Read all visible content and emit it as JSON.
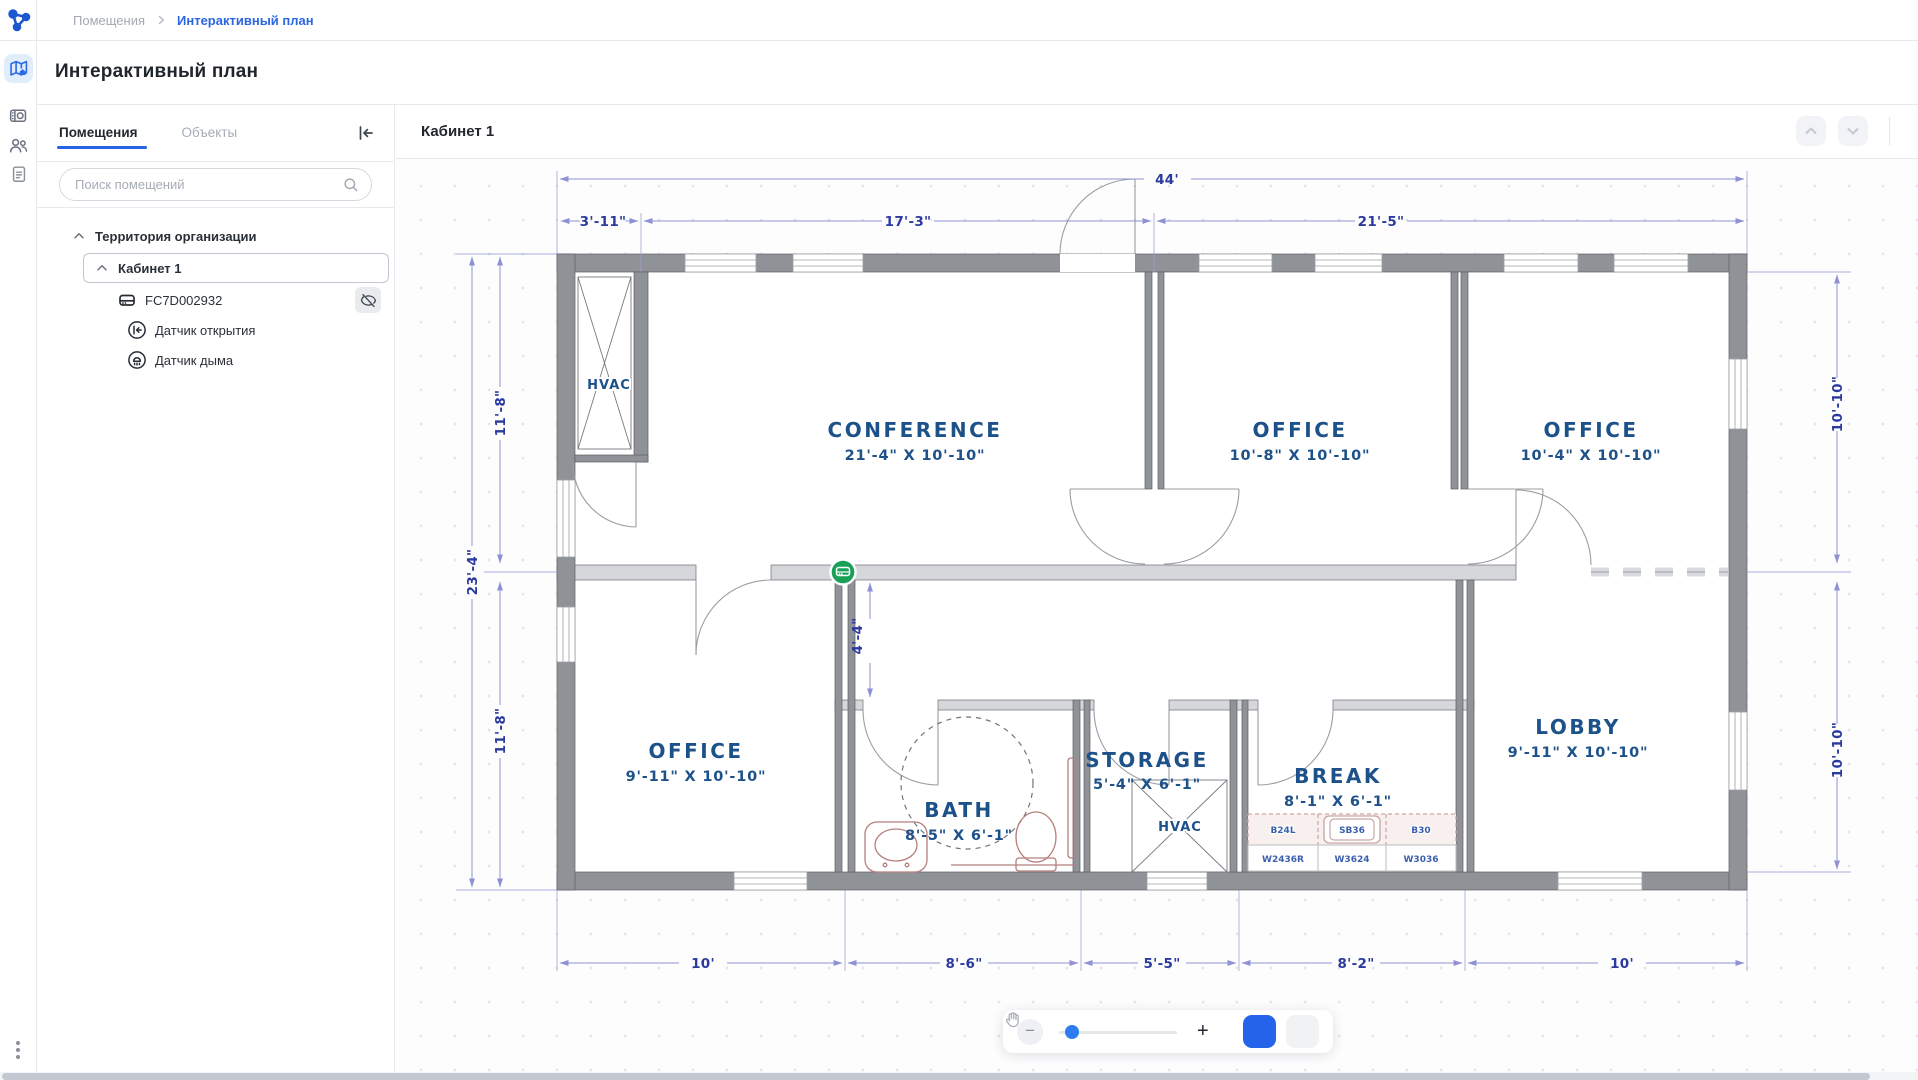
{
  "breadcrumb": {
    "root": "Помещения",
    "current": "Интерактивный план"
  },
  "page_title": "Интерактивный план",
  "sidebar": {
    "tabs": [
      {
        "label": "Помещения"
      },
      {
        "label": "Объекты"
      }
    ],
    "search_placeholder": "Поиск помещений",
    "tree": {
      "root": "Территория организации",
      "room": "Кабинет 1",
      "device": "FC7D002932",
      "sensors": [
        {
          "label": "Датчик открытия"
        },
        {
          "label": "Датчик дыма"
        }
      ]
    }
  },
  "main": {
    "header": "Кабинет 1"
  },
  "toolbar": {
    "zoom_out": "−",
    "zoom_in": "+"
  },
  "plan": {
    "dims": {
      "total_width": "44'",
      "seg1": "3'-11\"",
      "seg2": "17'-3\"",
      "seg3": "21'-5\"",
      "total_height": "23'-4\"",
      "left_top": "11'-8\"",
      "left_bottom": "11'-8\"",
      "right_top": "10'-10\"",
      "right_bottom": "10'-10\"",
      "hall": "4'-4\"",
      "bottom1": "10'",
      "bottom2": "8'-6\"",
      "bottom3": "5'-5\"",
      "bottom4": "8'-2\"",
      "bottom5": "10'"
    },
    "rooms": {
      "hvac_closet": "HVAC",
      "conference": {
        "name": "CONFERENCE",
        "size": "21'-4\" X 10'-10\""
      },
      "office1": {
        "name": "OFFICE",
        "size": "10'-8\" X 10'-10\""
      },
      "office2": {
        "name": "OFFICE",
        "size": "10'-4\" X 10'-10\""
      },
      "office3": {
        "name": "OFFICE",
        "size": "9'-11\" X 10'-10\""
      },
      "bath": {
        "name": "BATH",
        "size": "8'-5\" X 6'-1\""
      },
      "storage": {
        "name": "STORAGE",
        "size": "5'-4\" X 6'-1\""
      },
      "storage_hvac": "HVAC",
      "break": {
        "name": "BREAK",
        "size": "8'-1\" X 6'-1\""
      },
      "lobby": {
        "name": "LOBBY",
        "size": "9'-11\" X 10'-10\""
      }
    },
    "cabinets": [
      "B24L",
      "SB36",
      "B30",
      "W2436R",
      "W3624",
      "W3036"
    ]
  },
  "colors": {
    "accent": "#2563eb",
    "plan_text": "#2b3a9e",
    "room_label": "#1d5189",
    "marker_green": "#18a056"
  }
}
